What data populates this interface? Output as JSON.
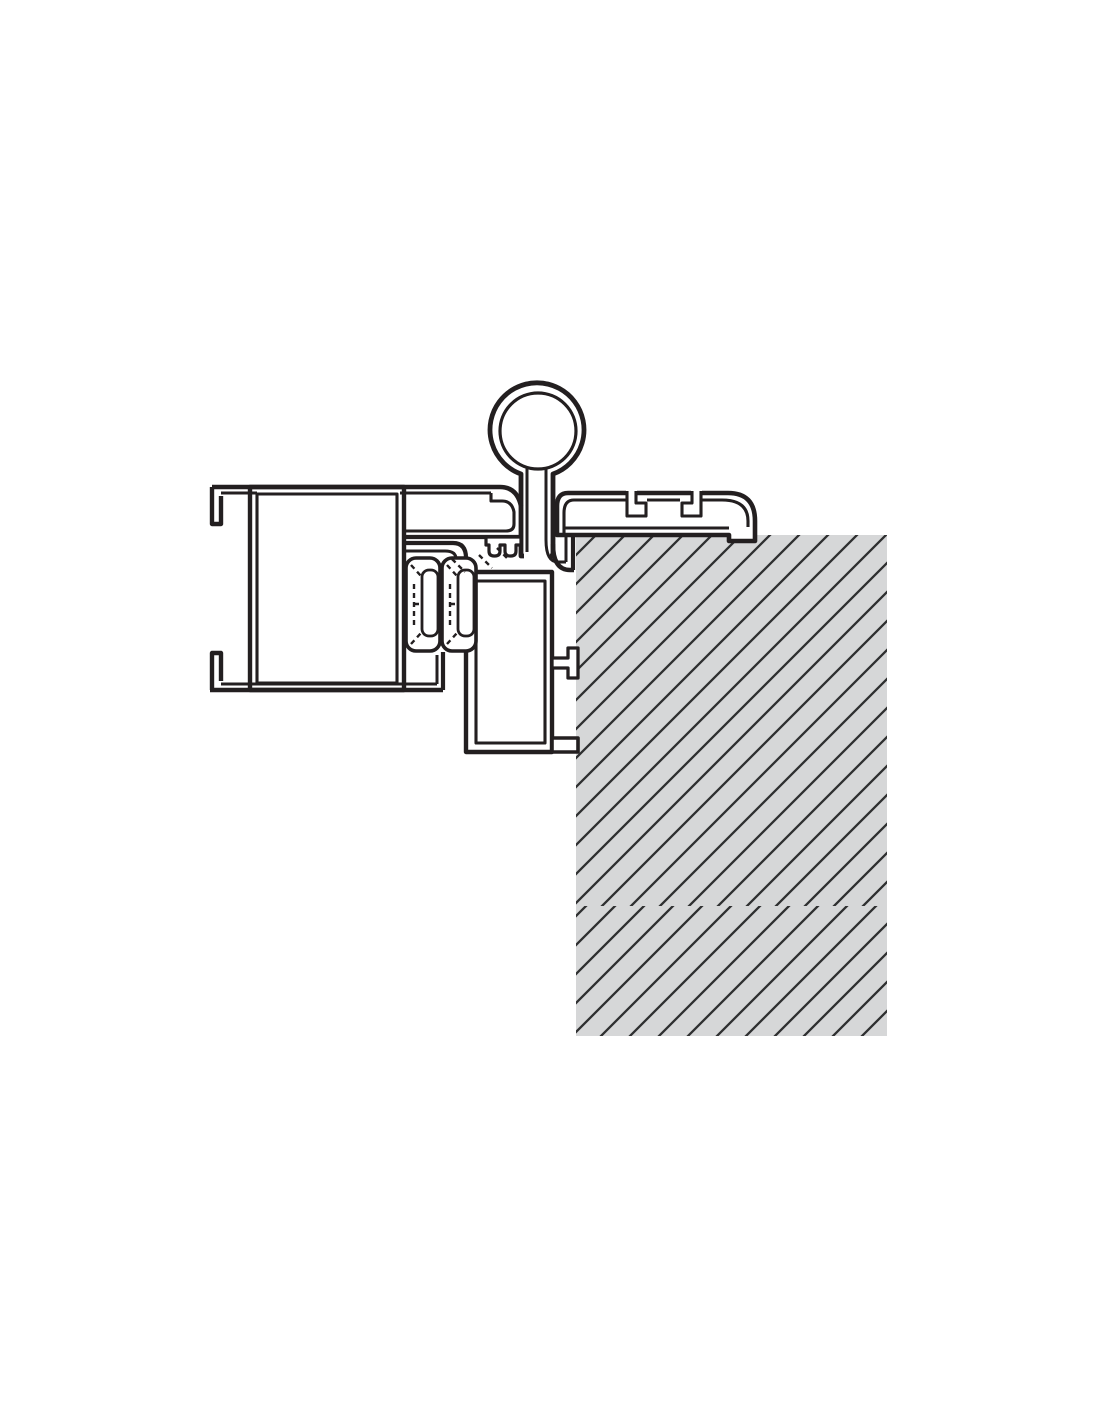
{
  "meta": {
    "canvas_width": 1100,
    "canvas_height": 1422,
    "background_color": "#ffffff",
    "line_color": "#231f20",
    "drawing_type": "frame-hinge-wall-cross-section"
  },
  "wall": {
    "fill": "#d6d7d8",
    "hatch_color": "#2e2f30",
    "hatch_stroke_width": 2.3,
    "hatch_spacing": 29,
    "panels": [
      {
        "name": "wall-hatch-upper",
        "x": 576,
        "y": 535,
        "w": 311,
        "h": 371,
        "pattern": "hatchA"
      },
      {
        "name": "wall-hatch-lower",
        "x": 576,
        "y": 906,
        "w": 311,
        "h": 130,
        "pattern": "hatchB"
      }
    ]
  },
  "shapes": [
    {
      "n": "frame-cell-outer",
      "t": "rect",
      "x": 250,
      "y": 487,
      "w": 154,
      "h": 203,
      "f": "#ffffff",
      "sw": 4.4
    },
    {
      "n": "frame-cell-inner",
      "t": "rect",
      "x": 257,
      "y": 494,
      "w": 140,
      "h": 189,
      "f": "#ffffff",
      "sw": 3.1
    },
    {
      "n": "frame-hook-top",
      "t": "path",
      "d": "M 212,487 V 524 H 221 V 496",
      "sw": 4.4
    },
    {
      "n": "frame-hook-bottom",
      "t": "path",
      "d": "M 212,690 V 653 H 221 V 681",
      "sw": 4.4
    },
    {
      "n": "frame-bottom-outer",
      "t": "path",
      "d": "M 210,690 H 443",
      "sw": 4.6
    },
    {
      "n": "frame-bottom-inner",
      "t": "path",
      "d": "M 221,684 H 437",
      "sw": 3.1
    },
    {
      "n": "cavity-wall-outer",
      "t": "path",
      "d": "M 443,652 V 690",
      "sw": 4.2
    },
    {
      "n": "cavity-wall-inner",
      "t": "path",
      "d": "M 437,655 V 684",
      "sw": 3
    },
    {
      "n": "wall-profile-outer",
      "t": "path",
      "d": "M 557,535 V 506 Q 557,493 568,493 H 728 Q 755,493 755,521 V 541 H 729 V 535 Z",
      "f": "#ffffff",
      "sw": 4.6
    },
    {
      "n": "wall-profile-inner",
      "t": "path",
      "d": "M 564,535 V 513 Q 564,500 574,500 H 626 M 647,500 H 680 M 702,500 H 722 Q 748,500 748,521 V 527 M 729,528 H 564",
      "sw": 3.1
    },
    {
      "n": "t-slot-1-fill",
      "t": "path",
      "d": "M 626,489 H 637 V 497 H 647 V 517 H 626 Z",
      "f": "#ffffff",
      "sw": 0
    },
    {
      "n": "t-slot-1",
      "t": "path",
      "d": "M 627,491 V 516 H 646 V 503 H 636 V 491",
      "sw": 3.1
    },
    {
      "n": "t-slot-2-fill",
      "t": "path",
      "d": "M 702,489 H 691 V 497 H 681 V 517 H 702 Z",
      "f": "#ffffff",
      "sw": 0
    },
    {
      "n": "t-slot-2",
      "t": "path",
      "d": "M 701,491 V 516 H 682 V 503 H 692 V 491",
      "sw": 3.1
    },
    {
      "n": "hinge-knuckle",
      "t": "path",
      "d": "M 521,474 A 47 47 0 1 1 553,474 L 553,556 L 521,556 Z",
      "f": "#ffffff",
      "sw": 4.8
    },
    {
      "n": "hinge-seam-erase",
      "t": "rect",
      "x": 524,
      "y": 548,
      "w": 26,
      "h": 12,
      "f": "#ffffff",
      "sw": 0
    },
    {
      "n": "hinge-ring-inner",
      "t": "circle",
      "cx": 538,
      "cy": 431,
      "r": 38,
      "f": "#ffffff",
      "sw": 3.2
    },
    {
      "n": "hinge-stem-inner",
      "t": "path",
      "d": "M 527,468 V 552 M 546,468 V 540",
      "sw": 3
    },
    {
      "n": "top-beam-outer",
      "t": "path",
      "d": "M 212,487 H 500 Q 517,487 521,506",
      "sw": 4.6
    },
    {
      "n": "top-beam-inner",
      "t": "path",
      "d": "M 221,493 H 257 M 400,493 H 491",
      "sw": 3.1
    },
    {
      "n": "leaf-chamber",
      "t": "path",
      "d": "M 491,493 V 501 H 502 Q 512,501 514,512 V 524 Q 514,531 506,531 H 404",
      "sw": 3.1
    },
    {
      "n": "leaf-chamber-bottom",
      "t": "path",
      "d": "M 404,537 H 521",
      "sw": 4.2
    },
    {
      "n": "gasket-block",
      "t": "path",
      "d": "M 486,537 H 521 V 545 H 516 V 551 Q 516,556 511,556 H 510 Q 505,556 505,551 V 545 H 500 V 551 Q 500,556 495,556 H 494 Q 489,556 489,551 V 545 H 486 Z",
      "f": "#ffffff",
      "sw": 3.2
    },
    {
      "n": "jamb-box-outer",
      "t": "rect",
      "x": 466,
      "y": 572,
      "w": 86,
      "h": 180,
      "f": "#ffffff",
      "sw": 4.4
    },
    {
      "n": "jamb-box-inner",
      "t": "rect",
      "x": 476,
      "y": 581,
      "w": 69,
      "h": 162,
      "f": "#ffffff",
      "sw": 3.1
    },
    {
      "n": "gasket-2-outer",
      "t": "rect",
      "x": 442,
      "y": 558,
      "w": 34,
      "h": 93,
      "rx": 10,
      "f": "#ffffff",
      "sw": 3.6
    },
    {
      "n": "gasket-2-inner",
      "t": "rect",
      "x": 458,
      "y": 570,
      "w": 16,
      "h": 66,
      "rx": 7,
      "f": "#ffffff",
      "sw": 2.8
    },
    {
      "n": "gasket-2-brush",
      "t": "path",
      "d": "M 447,565 L 457,576 M 447,644 L 457,633 M 450,584 V 625 M 450,604 H 457",
      "sw": 2.4,
      "dash": "5 4"
    },
    {
      "n": "gasket-1-outer",
      "t": "rect",
      "x": 406,
      "y": 558,
      "w": 34,
      "h": 93,
      "rx": 10,
      "f": "#ffffff",
      "sw": 3.6
    },
    {
      "n": "gasket-1-inner",
      "t": "rect",
      "x": 422,
      "y": 570,
      "w": 16,
      "h": 66,
      "rx": 7,
      "f": "#ffffff",
      "sw": 2.8
    },
    {
      "n": "gasket-1-brush",
      "t": "path",
      "d": "M 411,565 L 421,576 M 411,644 L 421,633 M 414,584 V 625 M 414,604 H 421",
      "sw": 2.4,
      "dash": "5 4"
    },
    {
      "n": "jamb-elbow-outer",
      "t": "path",
      "d": "M 404,543 H 453 Q 466,543 466,558",
      "sw": 4.2
    },
    {
      "n": "jamb-elbow-inner",
      "t": "path",
      "d": "M 404,551 H 445 Q 456,551 456,559",
      "sw": 3
    },
    {
      "n": "pocket-wall-outer",
      "t": "path",
      "d": "M 573,534 V 570",
      "sw": 4.2
    },
    {
      "n": "pocket-wall-inner",
      "t": "path",
      "d": "M 566,534 V 562",
      "sw": 3
    },
    {
      "n": "stem-foot-outer",
      "t": "path",
      "d": "M 553,544 Q 553,570 570,570 L 574,570",
      "sw": 4.4
    },
    {
      "n": "stem-foot-inner",
      "t": "path",
      "d": "M 546,540 Q 546,562 558,562 L 566,562",
      "sw": 3
    },
    {
      "n": "anchor-tab",
      "t": "path",
      "d": "M 552,658 H 568 V 648 H 578 V 678 H 568 V 668 H 552 Z",
      "f": "#ffffff",
      "sw": 3.3
    },
    {
      "n": "anchor-foot",
      "t": "path",
      "d": "M 552,738 H 578 V 752 H 552 Z",
      "f": "#ffffff",
      "sw": 3.6
    },
    {
      "n": "seal-dashes",
      "t": "path",
      "d": "M 452,559 L 465,572 M 479,555 L 492,568 M 497,548 L 508,559",
      "sw": 2.4,
      "dash": "5 4"
    }
  ]
}
